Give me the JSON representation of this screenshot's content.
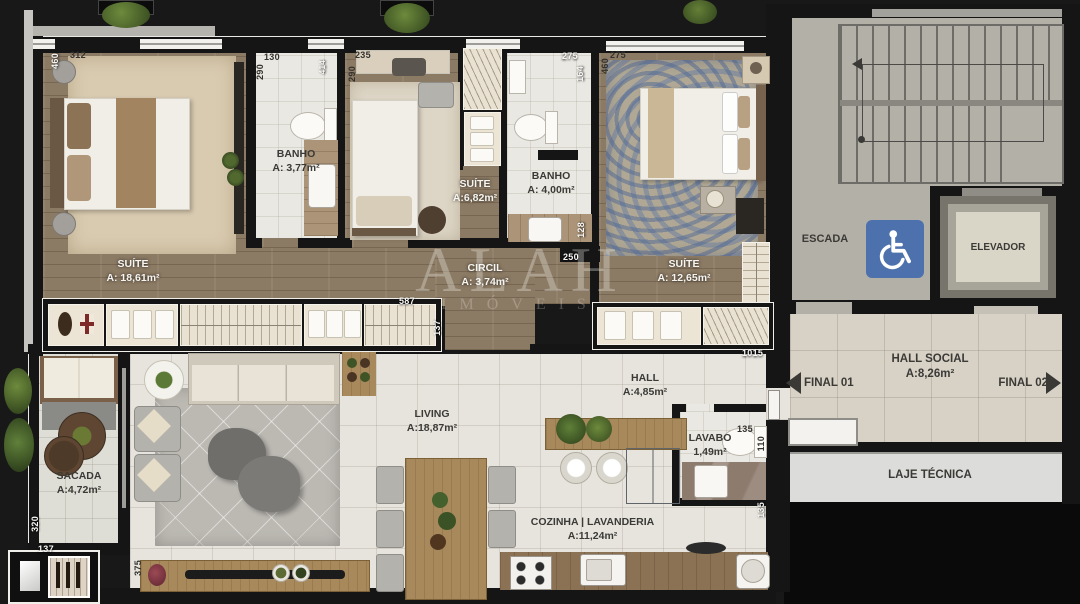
{
  "watermark": {
    "line1": "ALAH",
    "line2": "IMÓVEIS"
  },
  "rooms": {
    "suite1": {
      "name": "SUÍTE",
      "area": "A: 18,61m²"
    },
    "banho1": {
      "name": "BANHO",
      "area": "A: 3,77m²"
    },
    "suite2": {
      "name": "SUÍTE",
      "area": "A:6,82m²"
    },
    "banho2": {
      "name": "BANHO",
      "area": "A: 4,00m²"
    },
    "suite3": {
      "name": "SUÍTE",
      "area": "A: 12,65m²"
    },
    "circul": {
      "name": "CIRCIL",
      "area": "A: 3,74m²"
    },
    "hall": {
      "name": "HALL",
      "area": "A:4,85m²"
    },
    "living": {
      "name": "LIVING",
      "area": "A:18,87m²"
    },
    "sacada": {
      "name": "SACADA",
      "area": "A:4,72m²"
    },
    "cozinha": {
      "name": "COZINHA | LAVANDERIA",
      "area": "A:11,24m²"
    },
    "lavabo": {
      "name": "LAVABO",
      "area": "1,49m²"
    },
    "escada": {
      "name": "ESCADA"
    },
    "elevador": {
      "name": "ELEVADOR"
    },
    "hall_social": {
      "name": "HALL SOCIAL",
      "area": "A:8,26m²"
    },
    "laje": {
      "name": "LAJE TÉCNICA"
    },
    "final01": {
      "label": "FINAL 01"
    },
    "final02": {
      "label": "FINAL 02"
    }
  },
  "dimensions": [
    {
      "text": "460"
    },
    {
      "text": "312"
    },
    {
      "text": "130"
    },
    {
      "text": "290"
    },
    {
      "text": "235"
    },
    {
      "text": "290"
    },
    {
      "text": "414"
    },
    {
      "text": "275"
    },
    {
      "text": "164"
    },
    {
      "text": "275"
    },
    {
      "text": "460"
    },
    {
      "text": "128"
    },
    {
      "text": "250"
    },
    {
      "text": "587"
    },
    {
      "text": "137"
    },
    {
      "text": "1015"
    },
    {
      "text": "135"
    },
    {
      "text": "110"
    },
    {
      "text": "135"
    },
    {
      "text": "320"
    },
    {
      "text": "137"
    },
    {
      "text": "375"
    }
  ],
  "icons": {
    "accessible": "wheelchair-icon"
  },
  "colors": {
    "wall": "#151515",
    "wood_floor": "#8b7a64",
    "tile_floor": "#e7e4dd",
    "accessible_blue": "#4d71ad",
    "label_dark": "#3b3a36",
    "label_light": "#f6f5f1"
  }
}
